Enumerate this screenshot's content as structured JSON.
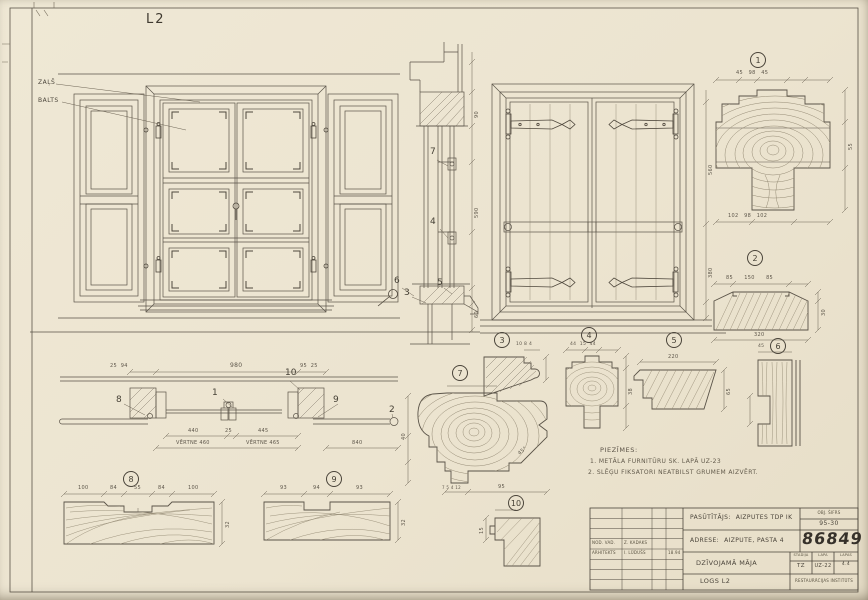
{
  "sheet": {
    "code": "L2"
  },
  "paint_labels": {
    "green": "ZAĻŠ",
    "white": "BALTS"
  },
  "callouts": {
    "c1": "1",
    "c2": "2",
    "c3": "3",
    "c4": "4",
    "c5": "5",
    "c6": "6",
    "c7": "7",
    "c8": "8",
    "c9": "9",
    "c10": "10"
  },
  "notes": {
    "heading": "PIEZĪMES:",
    "line1": "1. METĀLA FURNITŪRU SK. LAPĀ UZ-23",
    "line2": "2. SLĒĢU FIKSATORI NEATBILST GRUMEM AIZVĒRT."
  },
  "dims": {
    "plan_total": "980",
    "plan_left": "440",
    "plan_center": "25",
    "plan_right": "445",
    "plan_sash_left": "VĒRTNE 460",
    "plan_sash_right": "VĒRTNE 465",
    "plan_shutter": "840",
    "plan_small_left": "25  94",
    "plan_small_right": "95  25",
    "sec_top": "90",
    "sec_mid": "590",
    "sec_bottom": "60",
    "elev_upper": "560",
    "elev_lower": "380",
    "d1_top": "45   98   45",
    "d1_bottom": "102   98   102",
    "d1_side": "55",
    "d2_top": "85      150      85",
    "d2_bottom": "320",
    "d2_side": "30",
    "d3": "10 8 4",
    "d4_top": "44  15  44",
    "d4_side": "38",
    "d5_top": "220",
    "d5_side": "65",
    "d6_top": "45",
    "d7_bottom": "95",
    "d7_small": "7 5 4 12",
    "d7_angle": "45°",
    "d7_side": "40",
    "d8": [
      "100",
      "84",
      "55",
      "84",
      "100"
    ],
    "d8_depth": "32",
    "d9": [
      "93",
      "94",
      "93"
    ],
    "d9_depth": "32",
    "d10_side": "15"
  },
  "titleblock": {
    "client_label": "PASŪTĪTĀJS:",
    "client": "AIZPUTES TDP IK",
    "obj_label": "OBJ. ŠIFRS",
    "obj_code": "95-30",
    "address_label": "ADRESE:",
    "address": "AIZPUTE, PASTA 4",
    "project_number": "86849",
    "building": "DZĪVOJAMĀ MĀJA",
    "stage_label": "STADIJA",
    "stage": "TZ",
    "sheet_label": "LAPA",
    "sheet_no": "UZ-22",
    "sheets_label": "LAPAS",
    "sheets_total": "4.4",
    "drawing_title": "LOGS L2",
    "org": "RESTAURĀCIJAS INSTITŪTS",
    "row1_role": "NOD. VAD.",
    "row1_name": "Z. KADAKS",
    "row2_role": "ARHITEKTS",
    "row2_name": "I. LŪDUŠS",
    "row2_date": "18.94"
  }
}
